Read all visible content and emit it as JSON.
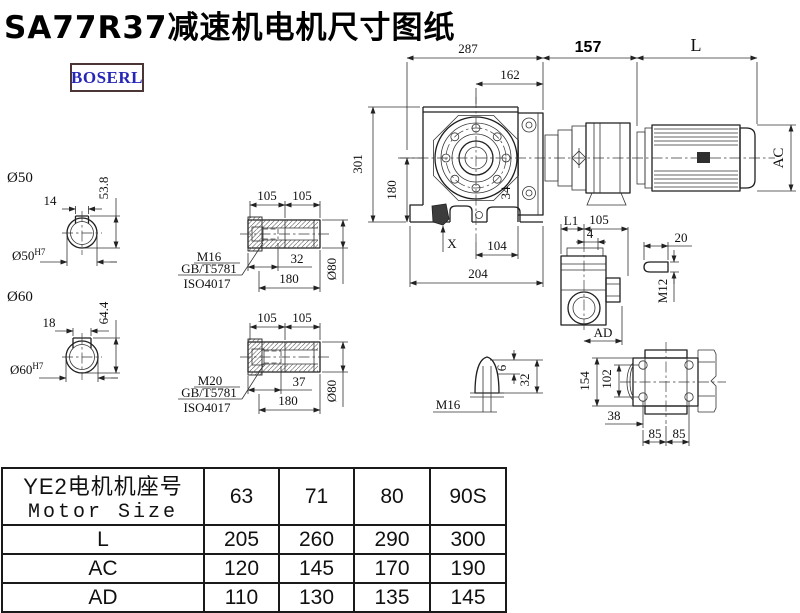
{
  "page": {
    "title": "SA77R37减速机电机尺寸图纸"
  },
  "logo": {
    "text": "BOSERL"
  },
  "drawing": {
    "labels": {
      "t287": "287",
      "t162": "162",
      "t157": "157",
      "tL": "L",
      "tAC": "AC",
      "t301": "301",
      "t180side": "180",
      "t34": "34",
      "tX": "X",
      "t104": "104",
      "t204": "204",
      "d50": "Ø50",
      "t14": "14",
      "t538": "53.8",
      "d50h7": "Ø50",
      "d50h7sup": "H7",
      "d60": "Ø60",
      "t18": "18",
      "t644": "64.4",
      "d60h7": "Ø60",
      "d60h7sup": "H7",
      "s1a": "105",
      "s1b": "105",
      "s1m": "M16",
      "s1gb": "GB/T5781",
      "s1iso": "ISO4017",
      "s1_32": "32",
      "s1_180": "180",
      "s1d80": "Ø80",
      "s2a": "105",
      "s2b": "105",
      "s2m": "M20",
      "s2gb": "GB/T5781",
      "s2iso": "ISO4017",
      "s2_37": "37",
      "s2_180": "180",
      "s2d80": "Ø80",
      "svL1": "L1",
      "sv105": "105",
      "sv4": "4",
      "svAD": "AD",
      "k20": "20",
      "kM12": "M12",
      "cM16": "M16",
      "c6": "6",
      "c32": "32",
      "r154": "154",
      "r102": "102",
      "r38": "38",
      "r85a": "85",
      "r85b": "85"
    }
  },
  "table": {
    "header": {
      "label_cn": "YE2电机机座号",
      "label_en": "Motor Size",
      "columns": [
        "63",
        "71",
        "80",
        "90S"
      ]
    },
    "rows": [
      {
        "label": "L",
        "values": [
          "205",
          "260",
          "290",
          "300"
        ]
      },
      {
        "label": "AC",
        "values": [
          "120",
          "145",
          "170",
          "190"
        ]
      },
      {
        "label": "AD",
        "values": [
          "110",
          "130",
          "135",
          "145"
        ]
      }
    ]
  }
}
